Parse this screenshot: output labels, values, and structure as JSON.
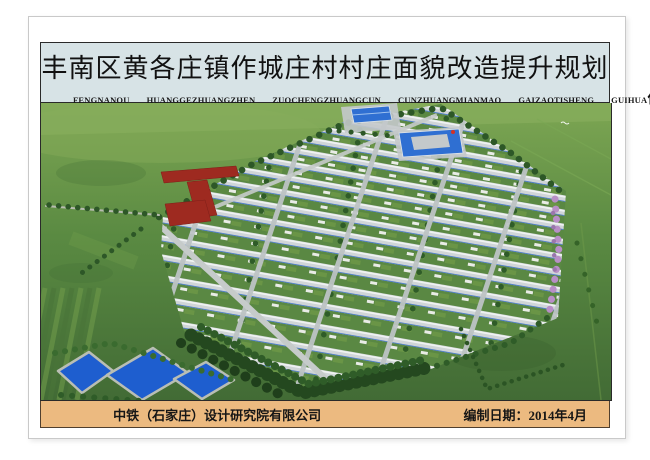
{
  "poster": {
    "header": {
      "title": "丰南区黄各庄镇作城庄村村庄面貌改造提升规划",
      "pinyin_words": [
        "FENGNANQU",
        "HUANGGEZHUANGZHEN",
        "ZUOCHENGZHUANGCUN",
        "CUNZHUANGMIANMAO",
        "GAIZAOTISHENG",
        "GUIHUA"
      ],
      "effect_label": "作城庄村规划效果图"
    },
    "footer": {
      "company": "中铁（石家庄）设计研究院有限公司",
      "date_label": "编制日期：2014年4月"
    },
    "colors": {
      "header_bg": "#d7e3e6",
      "footer_bg": "#ecba80",
      "plaza_red": "#9e2a20",
      "pond_blue": "#1e5ecf",
      "roof_grey": "#d0d5d7",
      "field_green": "#5a8a42",
      "public_roof_blue": "#2f6fd2",
      "blossom_pink": "#b88fc6"
    }
  }
}
